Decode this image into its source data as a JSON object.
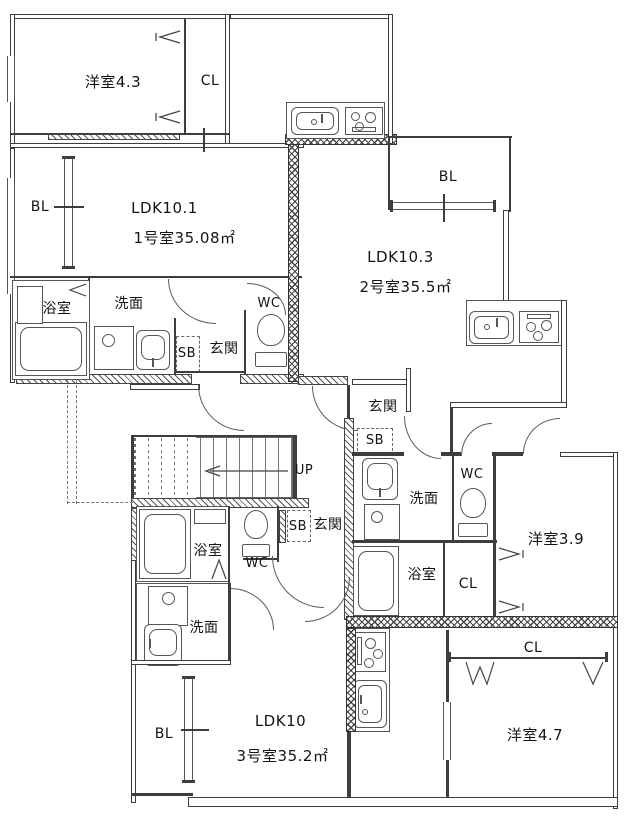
{
  "document": {
    "type": "apartment-floor-plan"
  },
  "rooms": {
    "western_4_3": "洋室4.3",
    "western_3_9": "洋室3.9",
    "western_4_7": "洋室4.7",
    "closet": "CL",
    "balcony": "BL",
    "bath": "浴室",
    "washroom": "洗面",
    "wc": "WC",
    "shoe_box": "SB",
    "entrance": "玄関",
    "stairs_up": "UP"
  },
  "units": {
    "unit1": {
      "ldk": "LDK10.1",
      "room_info": "1号室35.08㎡"
    },
    "unit2": {
      "ldk": "LDK10.3",
      "room_info": "2号室35.5㎡"
    },
    "unit3": {
      "ldk": "LDK10",
      "room_info": "3号室35.2㎡"
    }
  },
  "colors": {
    "line": "#3d3d3d",
    "background": "#ffffff"
  }
}
